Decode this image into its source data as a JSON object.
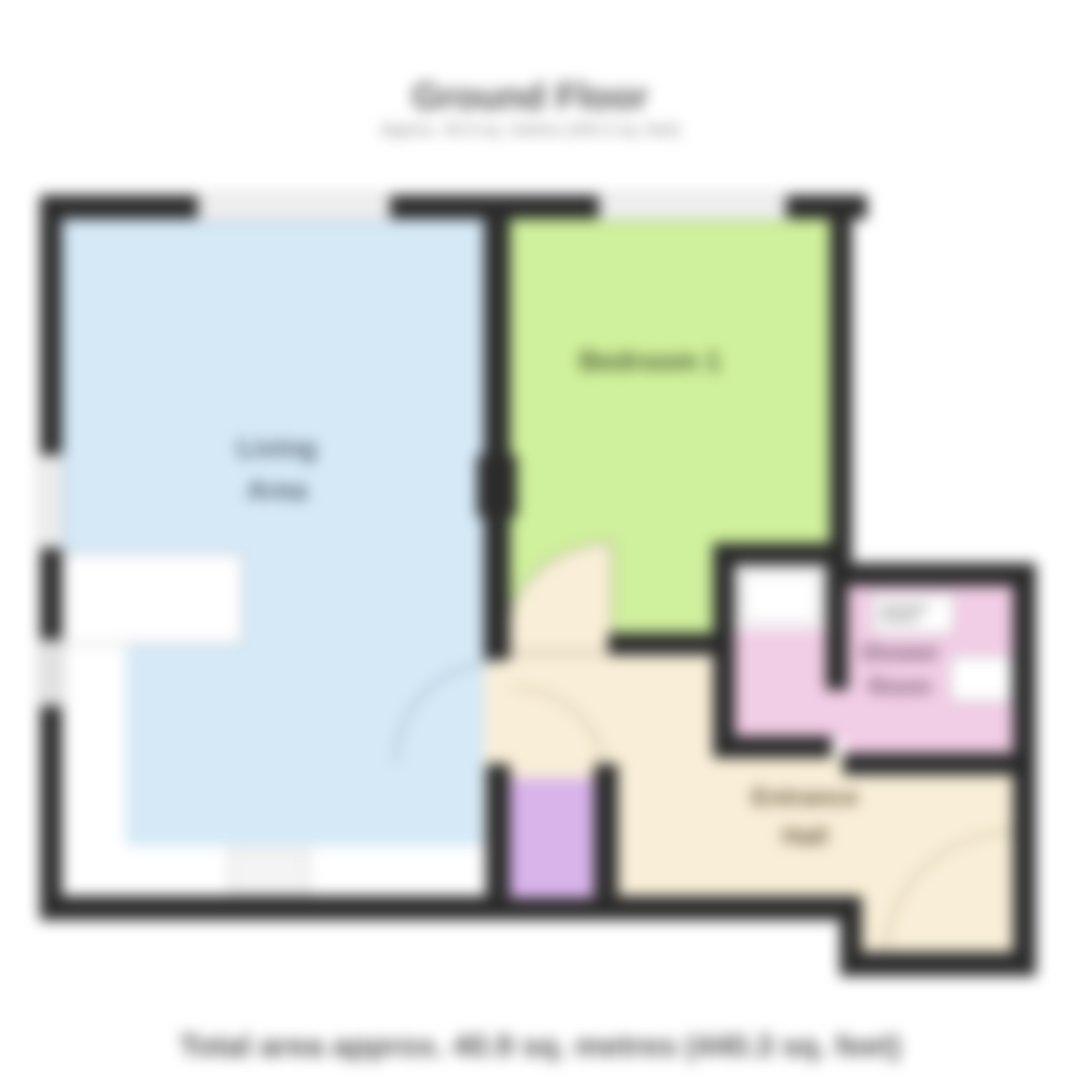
{
  "header": {
    "title": "Ground Floor",
    "subtitle": "Approx. 40.9 sq. metres (440.3 sq. feet)"
  },
  "footer": {
    "caption": "Total area approx. 40.9 sq. metres (440.3 sq. feet)"
  },
  "rooms": {
    "living": {
      "label": "Living\nArea",
      "color": "#d5e9f7"
    },
    "bedroom": {
      "label": "Bedroom 1",
      "color": "#cff09c"
    },
    "shower": {
      "label": "Shower\nRoom",
      "color": "#f2cde6"
    },
    "hall": {
      "label": "Entrance\nHall",
      "color": "#f9efd8"
    },
    "closet": {
      "color": "#d9b4ea"
    }
  },
  "plan": {
    "wall_color": "#2b2b2b",
    "window_color": "#ffffff"
  }
}
